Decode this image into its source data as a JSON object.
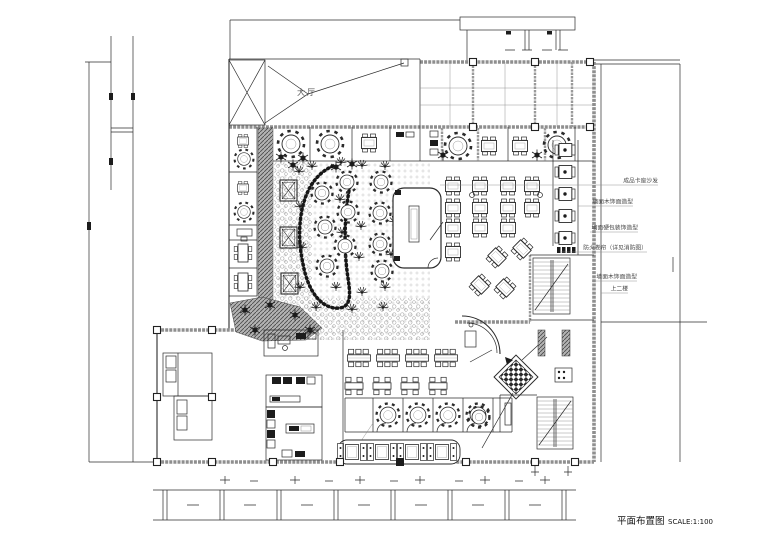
{
  "title": {
    "name": "平面布置图",
    "scale": "SCALE:1:100"
  },
  "plan": {
    "hall_label": "大厅"
  },
  "annotations": {
    "right": [
      {
        "label": "成品卡座沙发"
      },
      {
        "label": "墙面木饰面造型"
      },
      {
        "label": "墙面硬包装饰造型"
      },
      {
        "label": "防火卷帘（详见消防图）"
      },
      {
        "label": "墙面木饰面造型"
      },
      {
        "label": "上二楼"
      }
    ]
  },
  "colors": {
    "line": "#2b2b2b",
    "wall_gray": "#8f8f8f",
    "dark_fill": "#1c1c1c",
    "paper": "#ffffff"
  }
}
